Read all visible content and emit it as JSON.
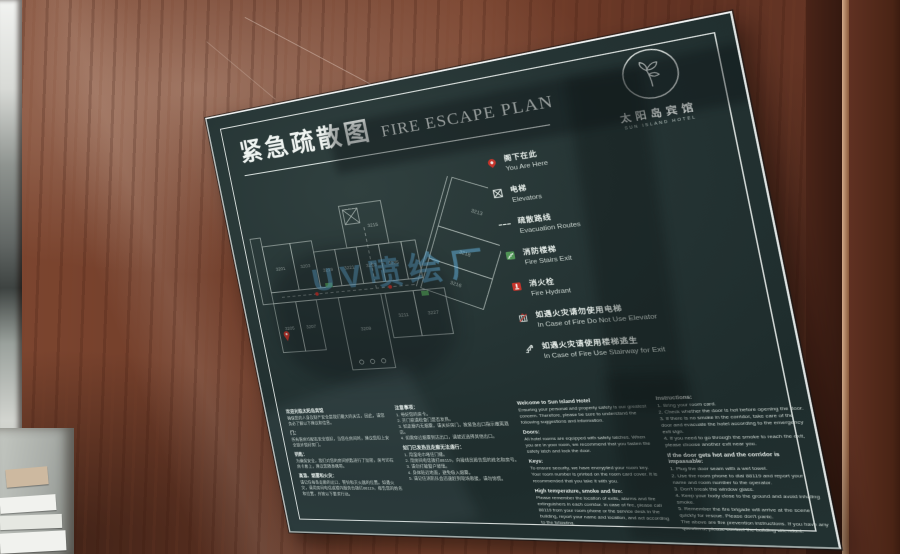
{
  "colors": {
    "wood": "#6d3a28",
    "panel": "#243434",
    "frame": "#eef3f0",
    "accent_red": "#c6342b",
    "accent_green": "#4f9455",
    "watermark_blue": "#5fb9eb",
    "plan_line": "#c9d4cf"
  },
  "sign": {
    "title_zh": "紧急疏散图",
    "title_en": "FIRE ESCAPE PLAN",
    "logo": {
      "hotel_zh": "太阳岛宾馆",
      "hotel_en": "SUN ISLAND HOTEL"
    },
    "watermark": "UV喷绘厂",
    "legend": [
      {
        "icon": "you-are-here-pin",
        "zh": "阁下在此",
        "en": "You Are Here"
      },
      {
        "icon": "elevator-box",
        "zh": "电梯",
        "en": "Elevators"
      },
      {
        "icon": "dashed-route-line",
        "zh": "疏散路线",
        "en": "Evacuation Routes"
      },
      {
        "icon": "fire-stairs-green",
        "zh": "消防楼梯",
        "en": "Fire Stairs Exit"
      },
      {
        "icon": "fire-hydrant-red",
        "zh": "消火栓",
        "en": "Fire Hydrant"
      },
      {
        "icon": "no-elevator",
        "zh": "如遇火灾请勿使用电梯",
        "en": "In Case of Fire Do Not Use Elevator"
      },
      {
        "icon": "stairway-exit",
        "zh": "如遇火灾请使用楼梯逃生",
        "en": "In Case of Fire Use Stairway for Exit"
      }
    ],
    "floor_plan": {
      "rooms": [
        "3201",
        "3203",
        "3205",
        "3207",
        "3209",
        "3211",
        "3213",
        "3215",
        "3216",
        "3218",
        "3219",
        "3221",
        "3223",
        "3225",
        "3227"
      ]
    },
    "columns": [
      {
        "blocks": [
          {
            "t": "h",
            "text": "欢迎光临太阳岛宾馆"
          },
          {
            "t": "p",
            "text": "确保您的人身及财产安全是我们最大的关注，因此，请您务必了解以下建议和信息。"
          },
          {
            "t": "h",
            "text": "门："
          },
          {
            "t": "p",
            "text": "所有客房均配有安全锁扣，当您在房间时，建议您扣上安全锁并锁好房门。"
          },
          {
            "t": "h",
            "text": "钥匙："
          },
          {
            "t": "p",
            "text": "为确保安全，我们对您的房间钥匙进行了加密，房号印在房卡套上，建议您随身携带。"
          },
          {
            "t": "h",
            "text": "高温、烟雾和火灾："
          },
          {
            "t": "p",
            "text": "请记住每条走廊的出口、警铃和灭火器的位置。如遇火灾，请用房间电话或楼内服务台拨打88119，报告您的姓名和位置，并按以下要求行动。"
          }
        ]
      },
      {
        "blocks": [
          {
            "t": "h",
            "text": "注意事项："
          },
          {
            "t": "p",
            "text": "1. 带好您的房卡。\n2. 开门前请检查门是否发热。\n3. 如走廊内无烟雾，请关好房门，按紧急出口指示撤离酒店。\n4. 如需穿过烟雾到达出口，请就近选择其他出口。"
          },
          {
            "t": "h",
            "text": "如门已发热且走廊无法通行："
          },
          {
            "t": "p",
            "text": "1. 用湿毛巾堵住门缝。\n2. 用房间电话拨打88119，向接线员报告您的姓名和房号。\n3. 请勿打破窗户玻璃。\n4. 身体贴近地面，避免吸入烟雾。\n5. 请记住消防队会迅速赶到现场救援，请勿惊慌。"
          }
        ]
      },
      {
        "blocks": [
          {
            "t": "h",
            "text": "Welcome to Sun Island Hotel"
          },
          {
            "t": "p",
            "text": "Ensuring your personal and property safety is our greatest concern. Therefore, please be sure to understand the following suggestions and information."
          },
          {
            "t": "h",
            "text": "Doors:"
          },
          {
            "t": "p",
            "text": "All hotel rooms are equipped with safety latches. When you are in your room, we recommend that you fasten the safety latch and lock the door."
          },
          {
            "t": "h",
            "text": "Keys:"
          },
          {
            "t": "p",
            "text": "To ensure security, we have encrypted your room key. Your room number is printed on the room card cover. It is recommended that you take it with you."
          },
          {
            "t": "h",
            "text": "High temperature, smoke and fire:"
          },
          {
            "t": "p",
            "text": "Please remember the location of exits, alarms and fire extinguishers in each corridor. In case of fire, please call 88119 from your room phone or the service desk in the building, report your name and location, and act according to the following."
          }
        ]
      },
      {
        "blocks": [
          {
            "t": "h",
            "text": "Instructions:"
          },
          {
            "t": "p",
            "text": "1. Bring your room card.\n2. Check whether the door is hot before opening the door.\n3. If there is no smoke in the corridor, take care of the door and evacuate the hotel according to the emergency exit sign.\n4. If you need to go through the smoke to reach the exit, please choose another exit near you."
          },
          {
            "t": "h",
            "text": "If the door gets hot and the corridor is impassable:"
          },
          {
            "t": "p",
            "text": "1. Plug the door seam with a wet towel.\n2. Use the room phone to dial 88119 and report your name and room number to the operator.\n3. Don't break the window glass.\n4. Keep your body close to the ground and avoid inhaling smoke.\n5. Remember the fire brigade will arrive at the scene quickly for rescue. Please don't panic."
          },
          {
            "t": "p",
            "text": "The above are fire prevention instructions. If you have any questions, please contact the building attendant."
          }
        ]
      }
    ]
  }
}
